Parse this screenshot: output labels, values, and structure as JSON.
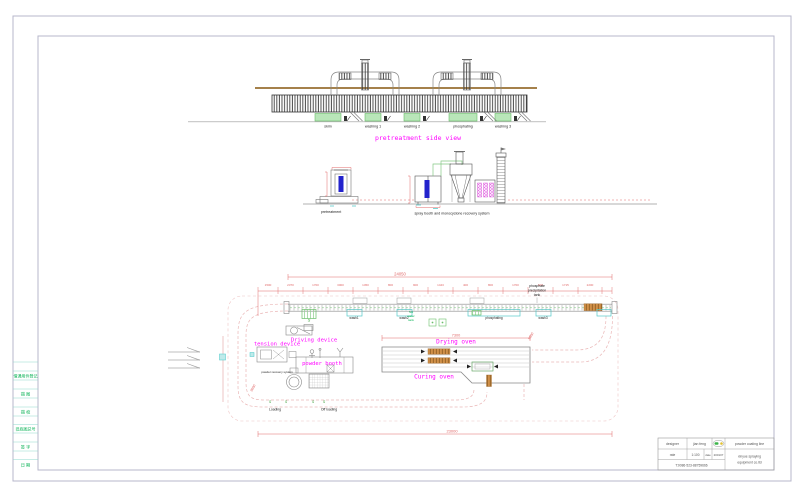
{
  "colors": {
    "border": "#b7b7cb",
    "magenta": "#ff00ff",
    "dim_red": "#e06868",
    "loop_pink": "#eab6b6",
    "tank_green_fill": "#b9e6b9",
    "tank_green_stroke": "#69c069",
    "cyan": "#50c8c8",
    "rail_brown": "#a5814b",
    "orange_block": "#d09048",
    "blue_part": "#2222cc",
    "green_text": "#00b050"
  },
  "side_view": {
    "title": "pretreatment side view",
    "tanks": [
      "skim",
      "washing 1",
      "washing 2",
      "phosphating",
      "washing 3"
    ]
  },
  "elevation": {
    "left_label": "pretreatment",
    "right_label": "spray booth and monocyclone recovery system"
  },
  "plan": {
    "total_dim": "24050",
    "segment_dims": [
      "1500",
      "2370",
      "1700",
      "3000",
      "1450",
      "800",
      "900",
      "1443",
      "400",
      "800",
      "1700",
      "600",
      "1715",
      "2200"
    ],
    "phosphate_tank": [
      "phosphate",
      "precipitation",
      "tank"
    ],
    "hot_water": [
      "hot",
      "water",
      "tank"
    ],
    "top_tanks": [
      "wash1",
      "wash2",
      "phosphating",
      "wash3"
    ],
    "hook_glyph": "S",
    "labels": {
      "tension_device": "tension device",
      "driving_device": "Driving device",
      "powder_booth": "powder booth",
      "powder_recovery": "powder recovery system",
      "drying_oven": "Drying oven",
      "curing_oven": "Curing oven",
      "loading": "Loading",
      "offloading": "Off loading"
    },
    "oven_dim": "7300",
    "bottom_dim": "23000",
    "left_dim": "3000",
    "right_dim": "5000"
  },
  "left_strip": {
    "rows": [
      "借通用件登记",
      "描 图",
      "描 校",
      "旧底图总号",
      "签 字",
      "日 期"
    ]
  },
  "title_block": {
    "designer_label": "designer",
    "designer_value": "jian feng",
    "rate_label": "rate",
    "rate_value": "1:100",
    "date_label": "date",
    "date_value": "200107",
    "phone": "T:0086-523-88759666",
    "product": "powder coating line",
    "company_line1": "xinyue spraying",
    "company_line2": "equipment co.ltd"
  }
}
